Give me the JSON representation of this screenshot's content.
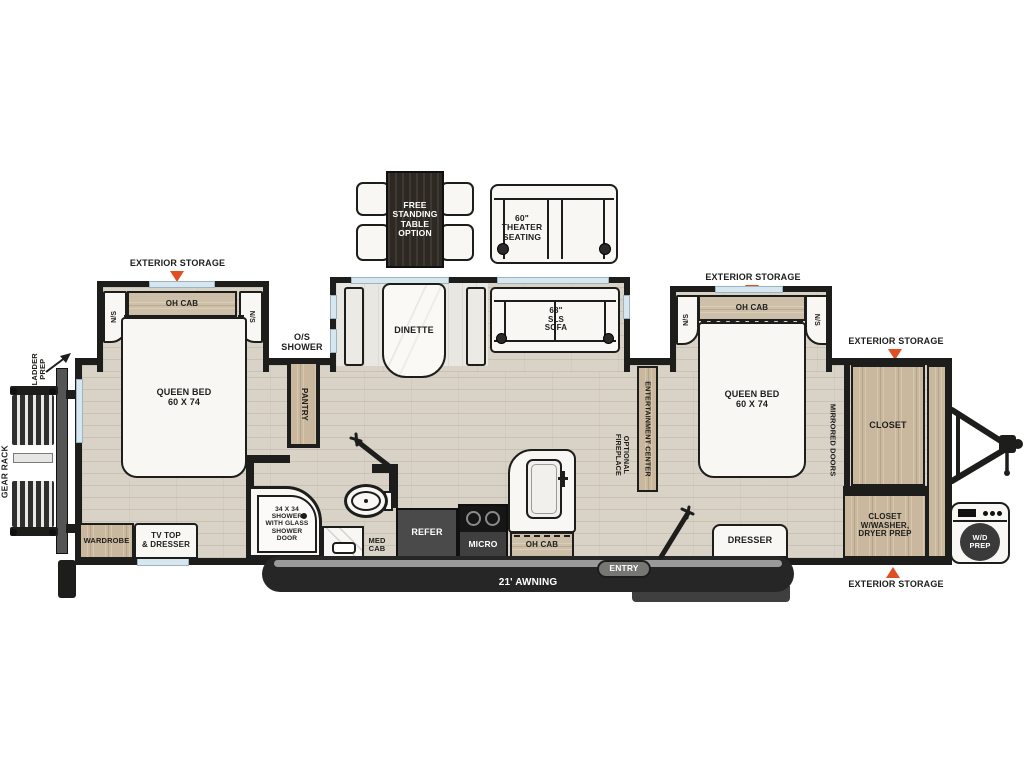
{
  "title": "Travel trailer floor plan",
  "colors": {
    "wall": "#1d1d1b",
    "floor_wood": "#d9d3c7",
    "cabinet_wood": "#c9b89e",
    "storage_arrow_accent": "#e04e23",
    "appliance_dark": "#3f3f3f",
    "awning_bar": "#262626",
    "window_glass": "#d7e7f0"
  },
  "exterior": {
    "storage": "EXTERIOR STORAGE",
    "os_shower": "O/S\nSHOWER",
    "ladder_prep": "LADDER\nPREP",
    "gear_rack": "GEAR RACK",
    "awning": "21' AWNING",
    "entry": "ENTRY",
    "wd_prep": "W/D\nPREP"
  },
  "options": {
    "table": "FREE\nSTANDING\nTABLE\nOPTION",
    "theater": "60\"\nTHEATER\nSEATING"
  },
  "bedroom_left": {
    "oh_cab": "OH CAB",
    "ns": "N/S",
    "bed": "QUEEN BED\n60 X 74",
    "wardrobe": "WARDROBE",
    "tv_dresser": "TV TOP\n& DRESSER"
  },
  "living": {
    "dinette": "DINETTE",
    "sofa": "68\"\nSLS\nSOFA",
    "pantry": "PANTRY",
    "entertainment": "ENTERTAINMENT CENTER",
    "fireplace": "OPTIONAL\nFIREPLACE"
  },
  "bathroom": {
    "shower": "34 X 34\nSHOWER\nWITH GLASS\nSHOWER\nDOOR",
    "med_cab": "MED\nCAB"
  },
  "kitchen": {
    "refer": "REFER",
    "micro": "MICRO",
    "oh_cab": "OH CAB"
  },
  "bedroom_right": {
    "oh_cab": "OH CAB",
    "ns": "N/S",
    "bed": "QUEEN BED\n60 X 74",
    "dresser": "DRESSER",
    "mirrored_doors": "MIRRORED DOORS",
    "closet": "CLOSET",
    "closet_washer": "CLOSET\nW/WASHER,\nDRYER PREP"
  }
}
